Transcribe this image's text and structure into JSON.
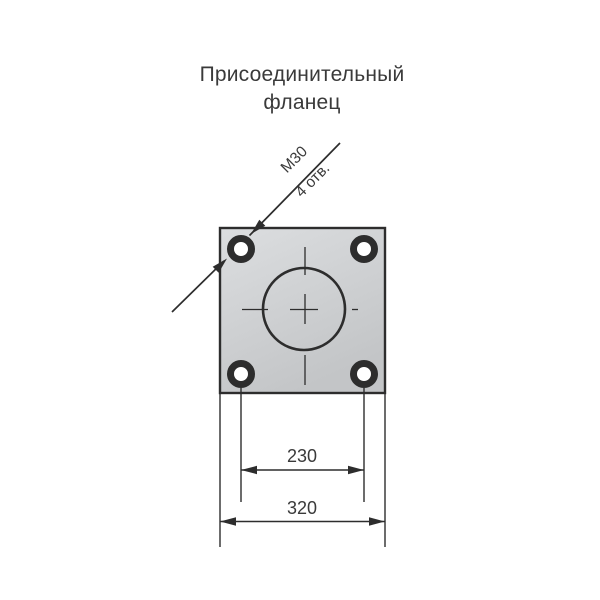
{
  "title": {
    "line1": "Присоединительный",
    "line2": "фланец"
  },
  "callout": {
    "thread_label": "M30",
    "holes_label": "4 отв."
  },
  "dimensions": {
    "hole_spacing": "230",
    "plate_width": "320"
  },
  "colors": {
    "line": "#2d2d2d",
    "text": "#3a3a3a",
    "plate_light": "#dcdee0",
    "plate_dark": "#c3c5c7",
    "hole_fill": "#ffffff",
    "background": "#ffffff"
  }
}
